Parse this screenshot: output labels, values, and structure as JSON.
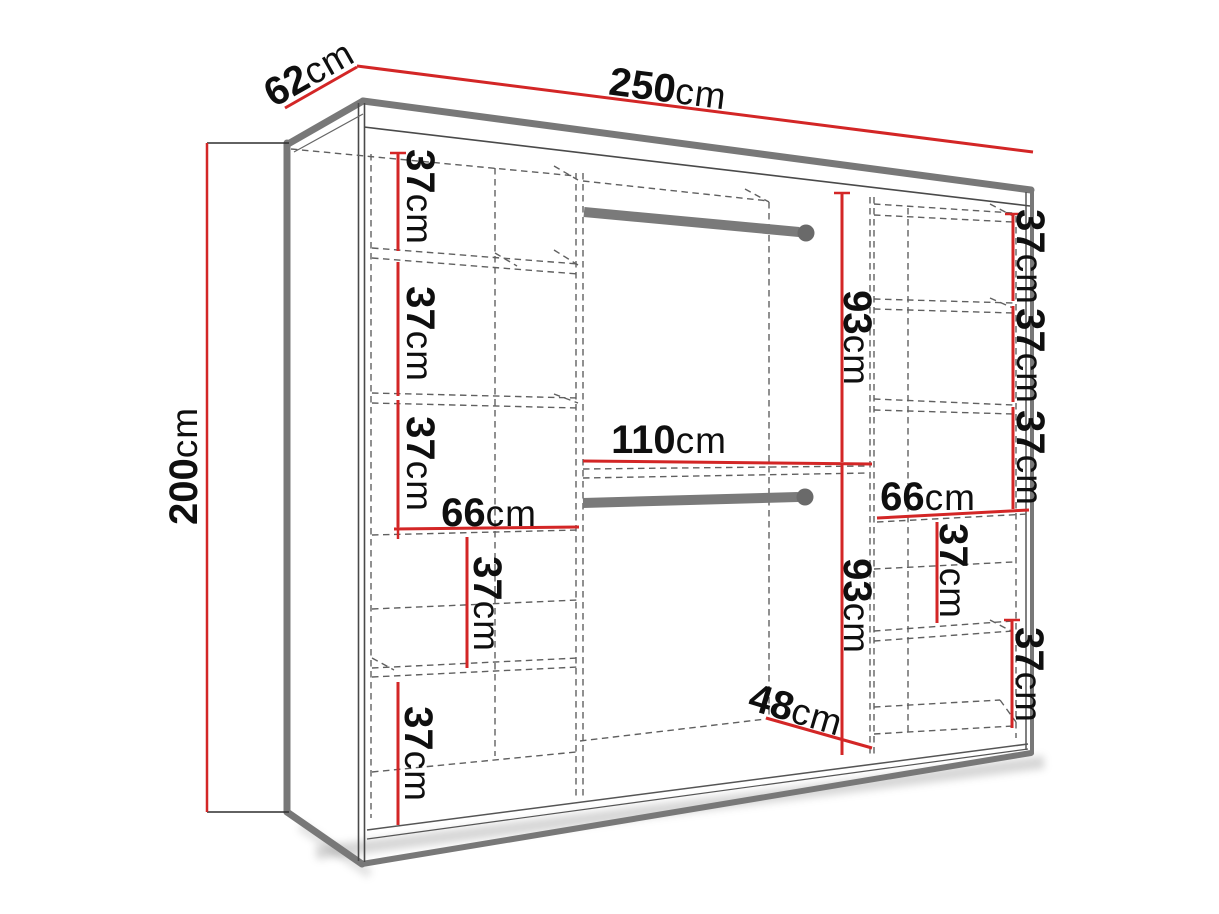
{
  "diagram": {
    "type": "furniture-dimension-diagram",
    "subject": "wardrobe-with-shelves-and-hanging-rods",
    "unit": "cm",
    "overall": {
      "width": "250",
      "depth": "62",
      "height": "200"
    },
    "colors": {
      "dimension_line": "#d32626",
      "structure_thick": "#787878",
      "structure_thin": "#4a4a4a",
      "dashed_line": "#606060",
      "label_text": "#0f0f0f",
      "background": "#ffffff"
    },
    "labels": [
      {
        "name": "overall-depth",
        "num": "62",
        "unit": "cm"
      },
      {
        "name": "overall-width",
        "num": "250",
        "unit": "cm"
      },
      {
        "name": "overall-height",
        "num": "200",
        "unit": "cm"
      },
      {
        "name": "left-shelf-gap-1",
        "num": "37",
        "unit": "cm"
      },
      {
        "name": "left-shelf-gap-2",
        "num": "37",
        "unit": "cm"
      },
      {
        "name": "left-shelf-gap-3",
        "num": "37",
        "unit": "cm"
      },
      {
        "name": "left-section-width",
        "num": "66",
        "unit": "cm"
      },
      {
        "name": "left-shelf-gap-4",
        "num": "37",
        "unit": "cm"
      },
      {
        "name": "left-shelf-gap-5",
        "num": "37",
        "unit": "cm"
      },
      {
        "name": "middle-upper-height",
        "num": "93",
        "unit": "cm"
      },
      {
        "name": "middle-section-width",
        "num": "110",
        "unit": "cm"
      },
      {
        "name": "middle-lower-height",
        "num": "93",
        "unit": "cm"
      },
      {
        "name": "bottom-interior-depth",
        "num": "48",
        "unit": "cm"
      },
      {
        "name": "right-section-width",
        "num": "66",
        "unit": "cm"
      },
      {
        "name": "right-shelf-gap-1",
        "num": "37",
        "unit": "cm"
      },
      {
        "name": "right-shelf-gap-2",
        "num": "37",
        "unit": "cm"
      },
      {
        "name": "right-shelf-gap-3",
        "num": "37",
        "unit": "cm"
      },
      {
        "name": "right-shelf-gap-4",
        "num": "37",
        "unit": "cm"
      },
      {
        "name": "right-shelf-gap-5",
        "num": "37",
        "unit": "cm"
      }
    ]
  }
}
